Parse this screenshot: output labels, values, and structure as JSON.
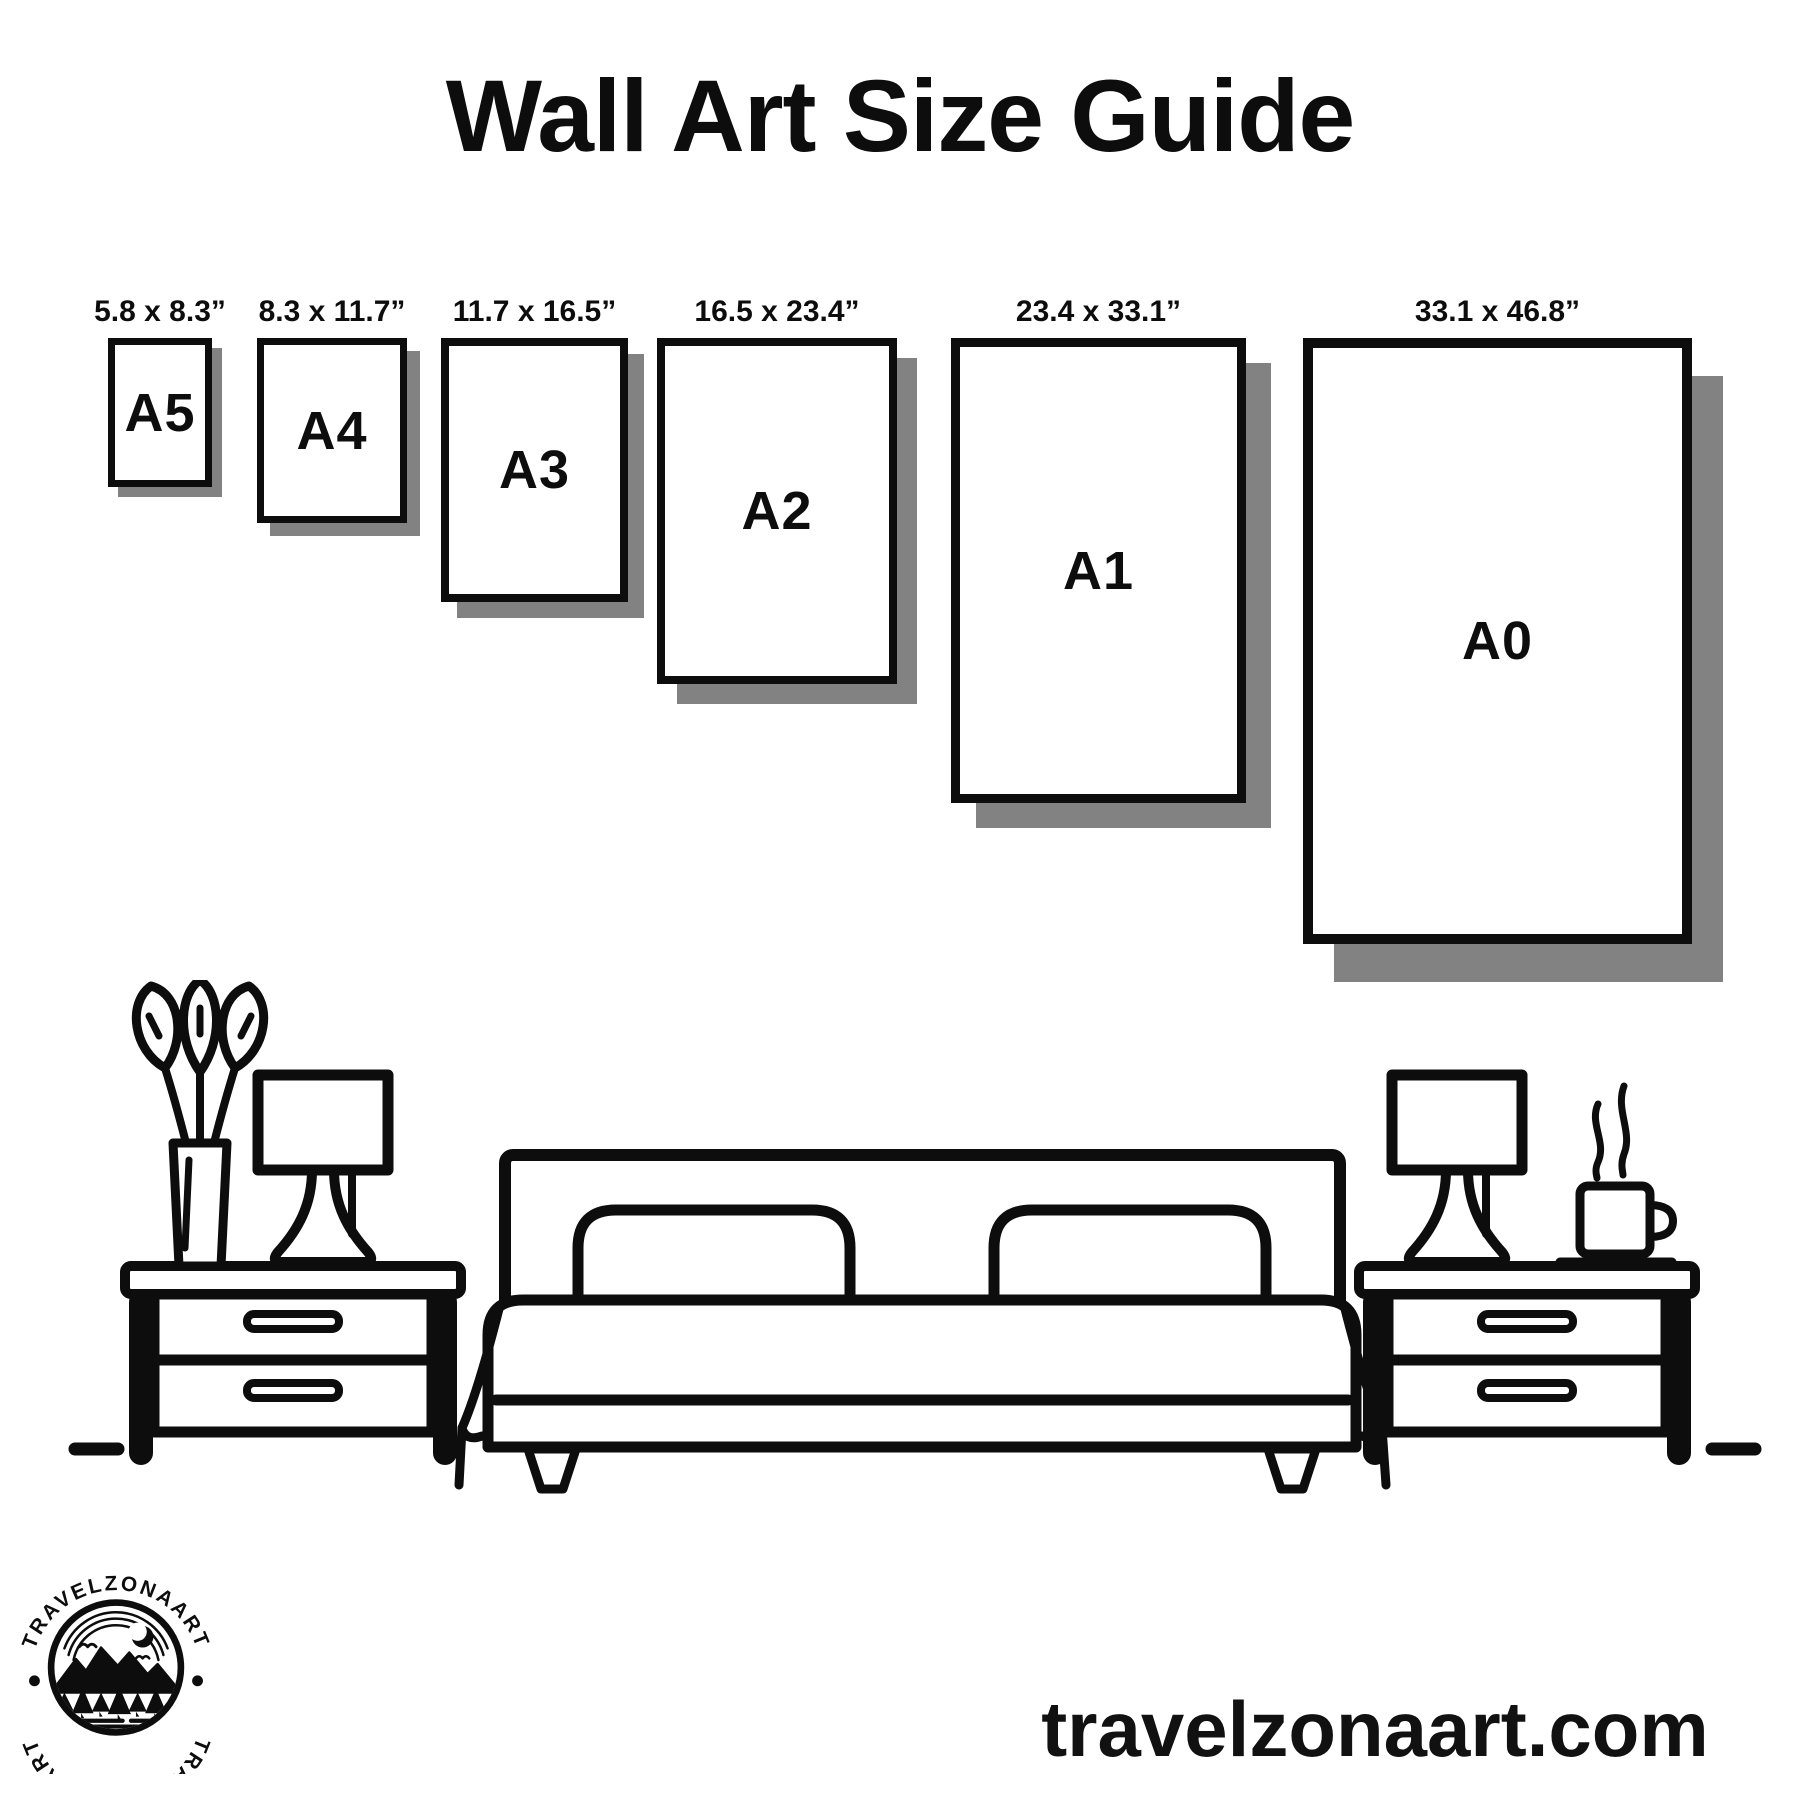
{
  "title": "Wall Art Size Guide",
  "sizes": [
    {
      "name": "A5",
      "dimensions": "5.8 x 8.3”"
    },
    {
      "name": "A4",
      "dimensions": "8.3 x 11.7”"
    },
    {
      "name": "A3",
      "dimensions": "11.7 x 16.5”"
    },
    {
      "name": "A2",
      "dimensions": "16.5 x 23.4”"
    },
    {
      "name": "A1",
      "dimensions": "23.4 x 33.1”"
    },
    {
      "name": "A0",
      "dimensions": "33.1 x 46.8”"
    }
  ],
  "logo": {
    "brand": "TRAVELZONAART"
  },
  "website": "travelzonaart.com",
  "colors": {
    "ink": "#0d0d0d",
    "shadow": "#828282",
    "background": "#ffffff"
  },
  "illustration": {
    "icons": [
      "flower-vase-icon",
      "table-lamp-icon",
      "bed-icon",
      "nightstand-icon",
      "coffee-cup-icon",
      "steam-icon",
      "ground-line-icon"
    ]
  }
}
